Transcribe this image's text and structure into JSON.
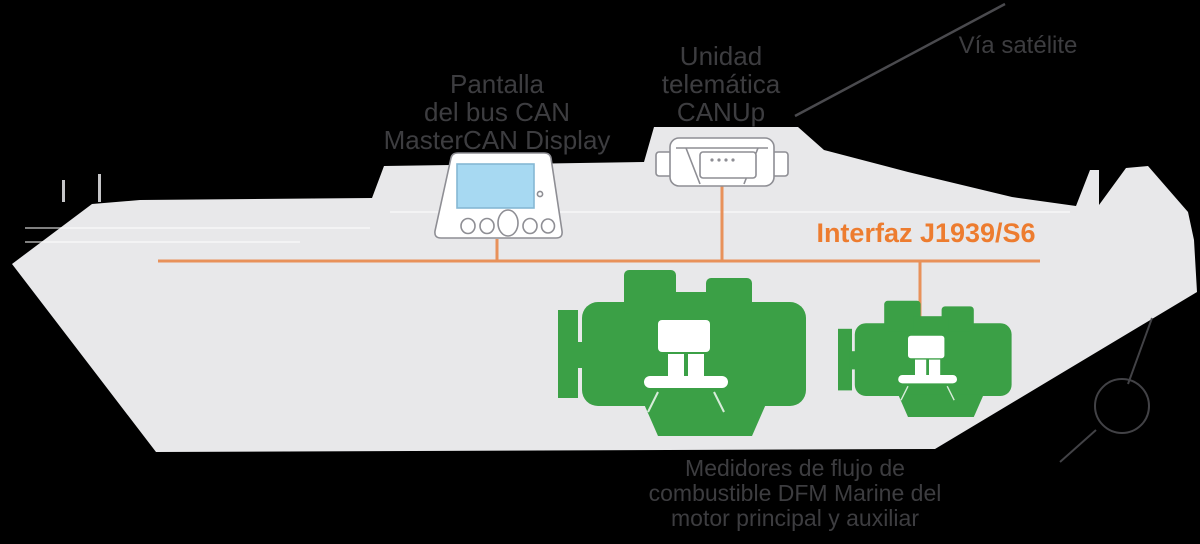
{
  "diagram": {
    "title": "Esquema de monitoreo de combustible en barco",
    "labels": {
      "display": {
        "lines": [
          "Pantalla",
          "del bus CAN",
          "MasterCAN Display"
        ]
      },
      "telematics": {
        "lines": [
          "Unidad",
          "telemática",
          "CANUp"
        ]
      },
      "satellite": {
        "text": "Vía satélite"
      },
      "interface": {
        "text": "Interfaz J1939/S6"
      },
      "flow_meters": {
        "lines": [
          "Medidores de flujo de",
          "combustible DFM Marine del",
          "motor principal y auxiliar"
        ]
      }
    },
    "colors": {
      "background": "#000000",
      "ship": "#E8E8EA",
      "accent_orange": "#ED7C2F",
      "bus_line_orange": "#E8915A",
      "engine_green": "#3BA046",
      "screen_blue": "#A7D9F2",
      "device_stroke": "#8E8E94",
      "text_dark": "#3D3D40",
      "antenna_line": "#4A4A4E"
    },
    "icons": {
      "ship": "ship-silhouette-icon",
      "display_device": "mastercan-display-icon",
      "telematics_device": "canup-gateway-icon",
      "main_engine": "main-engine-icon",
      "aux_engine": "auxiliary-engine-icon",
      "flow_meter": "dfm-flow-meter-icon",
      "antenna": "antenna-link-line",
      "bus": "j1939-bus-line",
      "propeller": "propeller-sketch-icon"
    }
  }
}
